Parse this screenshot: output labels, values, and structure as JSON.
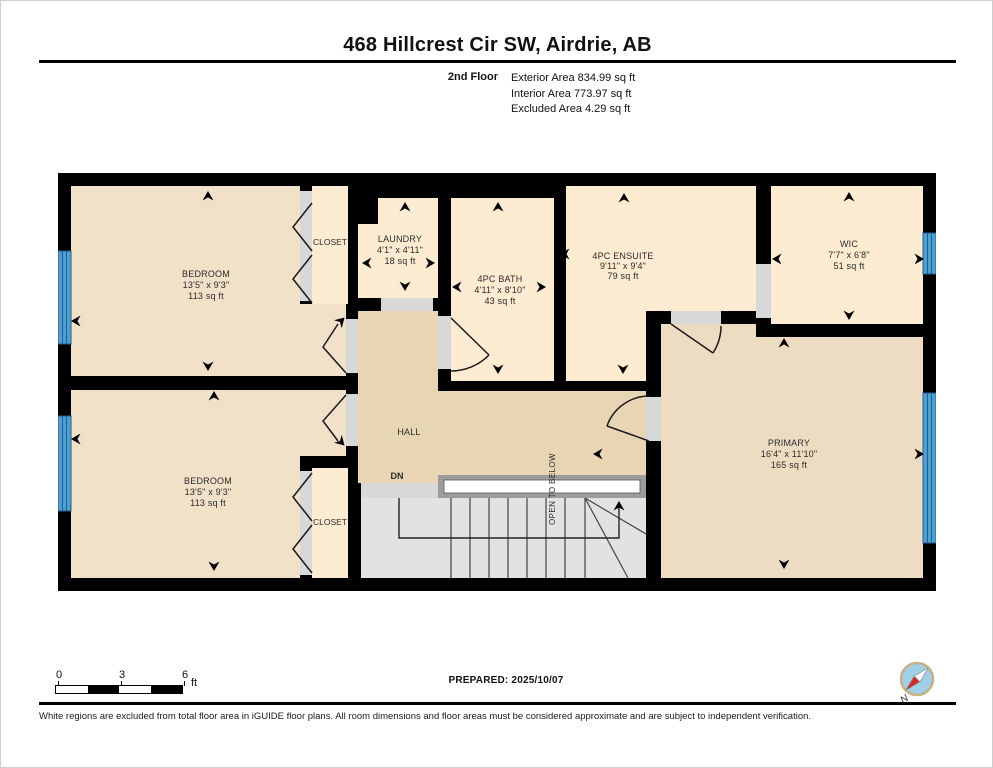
{
  "header": {
    "title": "468 Hillcrest Cir SW, Airdrie, AB",
    "floor_label": "2nd Floor",
    "area_lines": [
      "Exterior Area 834.99 sq ft",
      "Interior Area 773.97 sq ft",
      "Excluded Area 4.29 sq ft"
    ]
  },
  "plan": {
    "rooms": {
      "bedroom_top": {
        "name": "BEDROOM",
        "dims": "13'5\" x 9'3\"",
        "area": "113 sq ft"
      },
      "bedroom_bottom": {
        "name": "BEDROOM",
        "dims": "13'5\" x 9'3\"",
        "area": "113 sq ft"
      },
      "closet_top": {
        "name": "CLOSET"
      },
      "closet_bottom": {
        "name": "CLOSET"
      },
      "laundry": {
        "name": "LAUNDRY",
        "dims": "4'1\" x 4'11\"",
        "area": "18 sq ft"
      },
      "bath": {
        "name": "4PC BATH",
        "dims": "4'11\" x 8'10\"",
        "area": "43 sq ft"
      },
      "ensuite": {
        "name": "4PC ENSUITE",
        "dims": "9'11\" x 9'4\"",
        "area": "79 sq ft"
      },
      "wic": {
        "name": "WIC",
        "dims": "7'7\" x 6'8\"",
        "area": "51 sq ft"
      },
      "primary": {
        "name": "PRIMARY",
        "dims": "16'4\" x 11'10\"",
        "area": "165 sq ft"
      },
      "hall": {
        "name": "HALL"
      }
    },
    "labels": {
      "down": "DN",
      "open_to_below": "OPEN TO BELOW"
    },
    "colors": {
      "wall": "#000000",
      "room_light": "#fdebd2",
      "room_tan": "#f1e1c8",
      "room_primary": "#eedcc2",
      "hall": "#e8d5b3",
      "stairs": "#e2e2e2",
      "landing": "#d8d8d8",
      "railing": "#9c9c9c",
      "door_opening": "#d8d8d8",
      "window_blue": "#4ea0d0",
      "window_line": "#1e5f8f",
      "compass_red": "#d42a1e",
      "compass_blue": "#9fd0e8"
    }
  },
  "footer": {
    "scale": {
      "ticks": [
        "0",
        "3",
        "6"
      ],
      "unit": "ft"
    },
    "prepared": "PREPARED: 2025/10/07",
    "compass_label": "N",
    "disclaimer": "White regions are excluded from total floor area in iGUIDE floor plans. All room dimensions and floor areas must be considered approximate and are subject to independent verification."
  }
}
